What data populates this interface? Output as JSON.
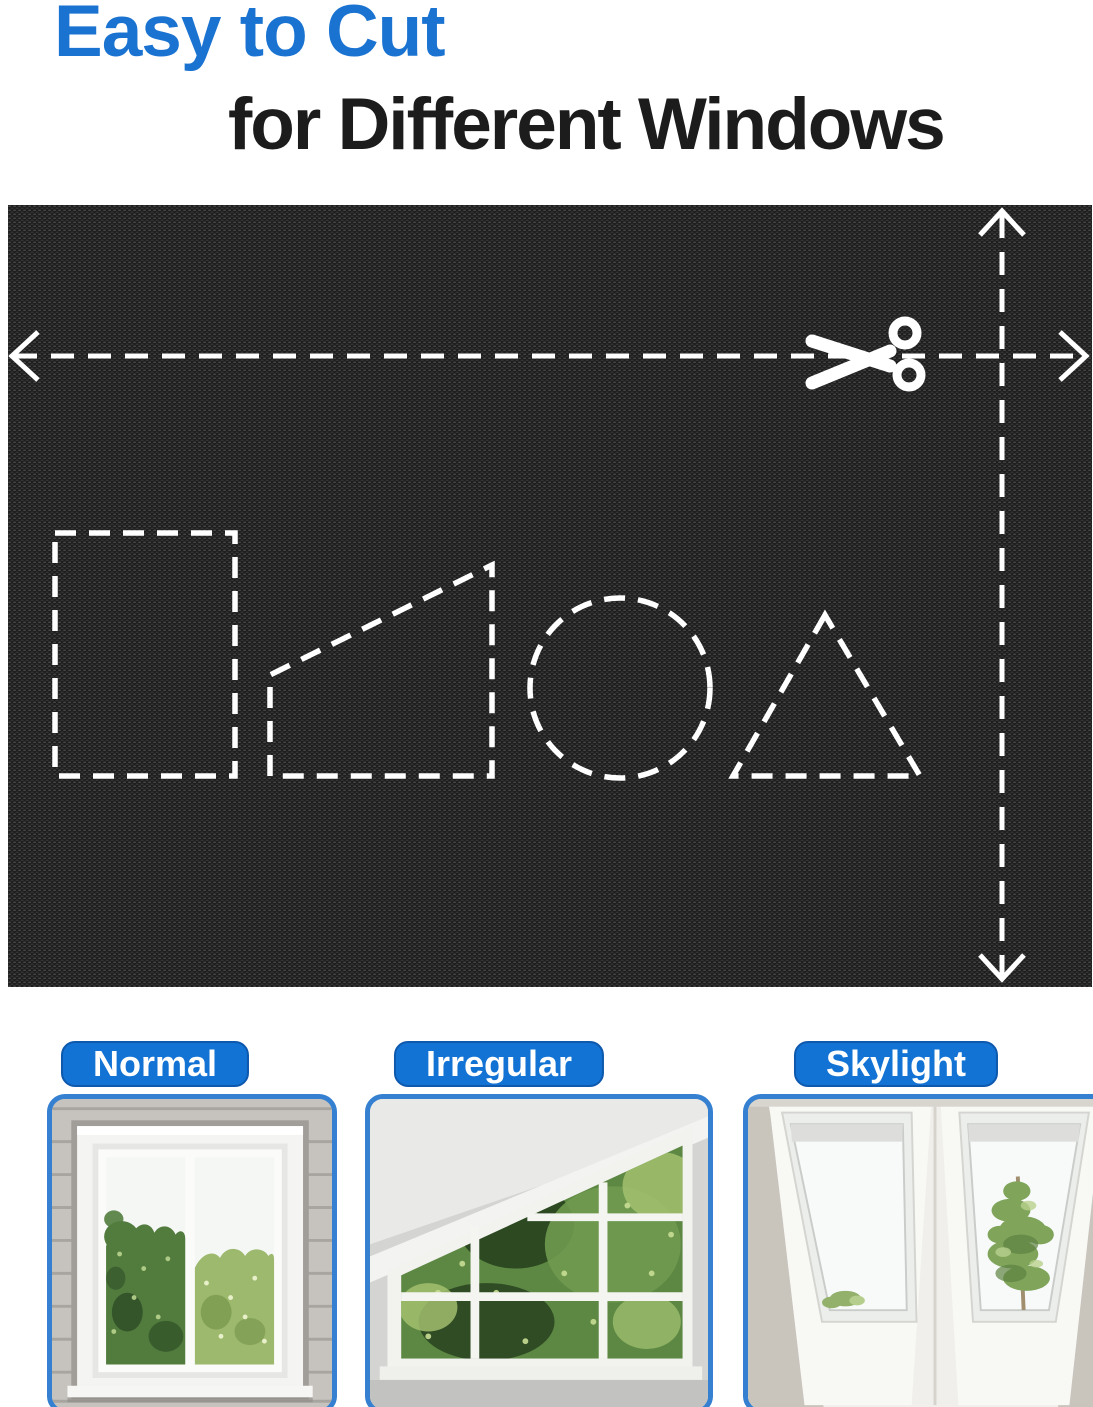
{
  "header": {
    "title_line1": "Easy to Cut",
    "title_line2": "for Different Windows"
  },
  "colors": {
    "accent_blue": "#1a73d1",
    "title_text": "#1c1c1c",
    "label_blue": "#1273d4",
    "label_border_blue": "#0e59ae",
    "card_border_blue": "#3580d0",
    "fabric_base": "#1d1d1d",
    "cut_line_white": "#ffffff"
  },
  "fabric_panel": {
    "icons": [
      "scissors-icon",
      "arrow-left-icon",
      "arrow-right-icon",
      "arrow-up-icon",
      "arrow-down-icon"
    ],
    "cut_shape_outlines": [
      "rectangle",
      "trapezoid",
      "circle",
      "triangle"
    ]
  },
  "window_cards": [
    {
      "label": "Normal"
    },
    {
      "label": "Irregular"
    },
    {
      "label": "Skylight"
    }
  ]
}
